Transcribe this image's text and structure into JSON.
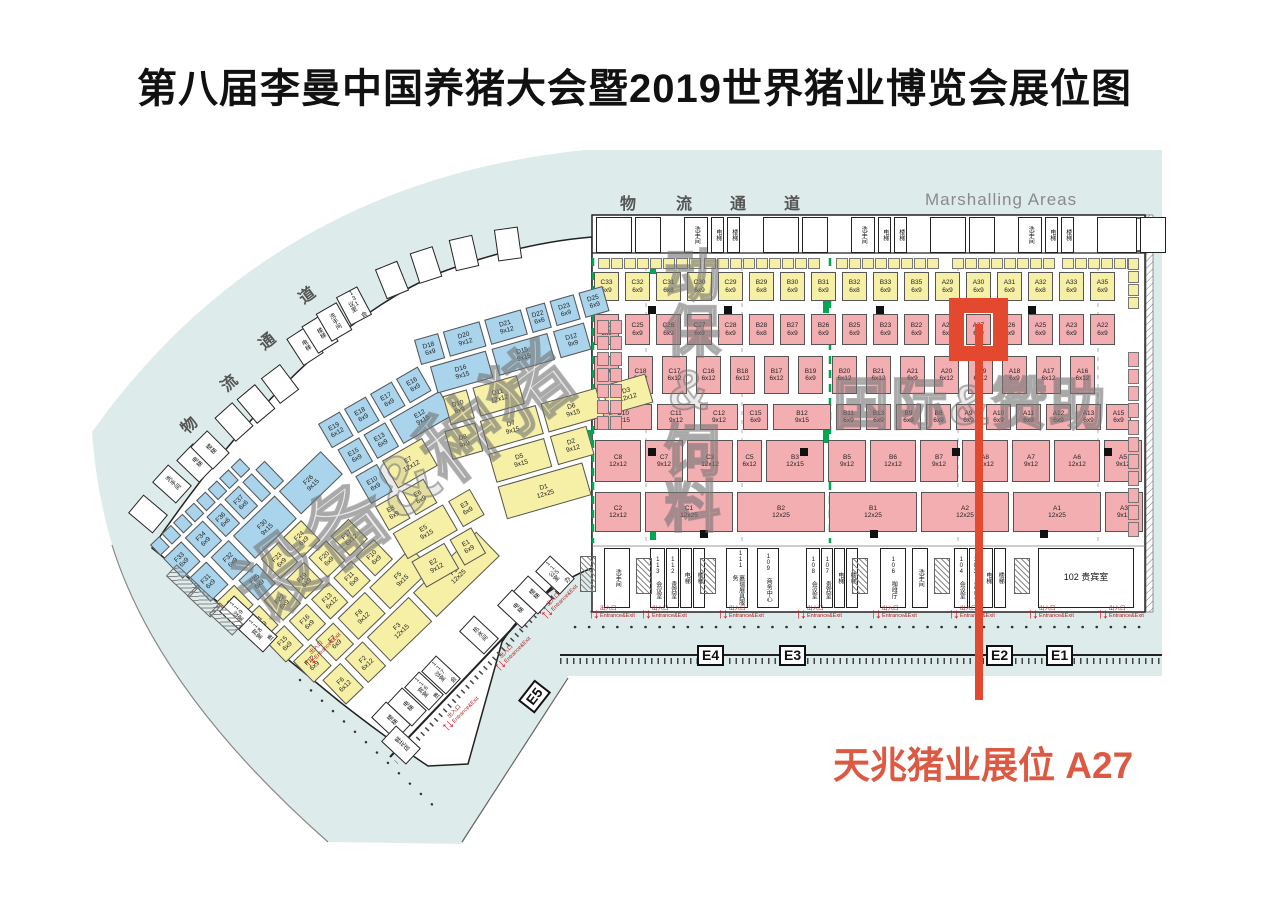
{
  "title": "第八届李曼中国养猪大会暨2019世界猪业博览会展位图",
  "labels": {
    "marshalling": "Marshalling Areas",
    "logistics_top": [
      "物",
      "流",
      "通",
      "道"
    ],
    "logistics_left": [
      "物",
      "流",
      "通",
      "道"
    ],
    "annotation": "天兆猪业展位 A27",
    "entrance_cn": "出入口",
    "entrance_en": "Entrance&Exit",
    "gates": [
      "E4",
      "E3",
      "E2",
      "E1",
      "E5"
    ]
  },
  "watermarks": {
    "equipment": "设备&种猪",
    "feed": "动保&饲料",
    "international": "国际&赞助"
  },
  "rooms": {
    "service": [
      "洗手间",
      "电梯",
      "楼梯"
    ],
    "bottom": [
      "洗手间",
      "113 会议室",
      "112 贵宾室",
      "电梯",
      "楼梯",
      "111 嘉瑞展具服务",
      "109 商务中心",
      "108 会议室",
      "107 贵宾室",
      "电梯",
      "楼梯",
      "106 咖啡厅",
      "洗手间",
      "104 会议室",
      "103 贵宾室",
      "电梯",
      "楼梯",
      "102 贵宾室"
    ],
    "curve": [
      "洗手间",
      "电梯",
      "楼梯",
      "电梯",
      "楼梯",
      "洗手间",
      "131 会议室"
    ],
    "fan_bottom": [
      "115 办公室",
      "楼梯",
      "电梯",
      "热水间",
      "117 会议室",
      "116 贵宾室",
      "电梯",
      "楼梯",
      "119 会议室",
      "118 贵宾室",
      "鲜花店"
    ]
  },
  "colors": {
    "concourse_teal": "#DDECEA",
    "booth_pink": "#F3AEB2",
    "booth_yellow": "#F6EFA6",
    "booth_blue": "#A9D4EB",
    "zone_green": "#00A651",
    "highlight_red": "#E2492E",
    "annotation_red": "#DC5A43"
  },
  "highlight": {
    "booth": "A27",
    "label": "天兆猪业展位 A27"
  },
  "halls": {
    "right": {
      "rows": [
        [
          [
            "C33",
            "6x9",
            "y"
          ],
          [
            "C32",
            "6x9",
            "y"
          ],
          [
            "C31",
            "6x8",
            "y"
          ],
          [
            "C30",
            "6x9",
            "y"
          ],
          [
            "C29",
            "6x9",
            "y"
          ],
          [
            "B29",
            "6x8",
            "y"
          ],
          [
            "B30",
            "6x9",
            "y"
          ],
          [
            "B31",
            "6x9",
            "y"
          ],
          [
            "B32",
            "6x8",
            "y"
          ],
          [
            "B33",
            "6x9",
            "y"
          ],
          [
            "B35",
            "6x9",
            "y"
          ],
          [
            "A29",
            "6x9",
            "y"
          ],
          [
            "A30",
            "6x9",
            "y"
          ],
          [
            "A31",
            "6x9",
            "y"
          ],
          [
            "A32",
            "6x8",
            "y"
          ],
          [
            "A33",
            "6x9",
            "y"
          ],
          [
            "A35",
            "6x9",
            "y"
          ]
        ],
        [
          [
            "C23",
            "6x9",
            "p"
          ],
          [
            "C25",
            "6x9",
            "p"
          ],
          [
            "C26",
            "6x9",
            "p"
          ],
          [
            "C27",
            "6x9",
            "p"
          ],
          [
            "C28",
            "6x9",
            "p"
          ],
          [
            "B28",
            "6x8",
            "p"
          ],
          [
            "B27",
            "6x9",
            "p"
          ],
          [
            "B26",
            "6x9",
            "p"
          ],
          [
            "B25",
            "6x9",
            "p"
          ],
          [
            "B23",
            "6x9",
            "p"
          ],
          [
            "B22",
            "6x9",
            "p"
          ],
          [
            "A28",
            "6x9",
            "p"
          ],
          [
            "A27",
            "6x9",
            "p",
            "hl"
          ],
          [
            "A26",
            "6x9",
            "p"
          ],
          [
            "A25",
            "6x9",
            "p"
          ],
          [
            "A23",
            "6x9",
            "p"
          ],
          [
            "A22",
            "6x9",
            "p"
          ]
        ],
        [
          [
            "C20",
            "6x12",
            "p"
          ],
          [
            "C18",
            "6x12",
            "p"
          ],
          [
            "C17",
            "6x12",
            "p"
          ],
          [
            "C16",
            "6x12",
            "p"
          ],
          [
            "B18",
            "6x12",
            "p"
          ],
          [
            "B17",
            "6x12",
            "p"
          ],
          [
            "B19",
            "6x9",
            "p"
          ],
          [
            "B20",
            "6x12",
            "p"
          ],
          [
            "B21",
            "6x12",
            "p"
          ],
          [
            "A21",
            "6x9",
            "p"
          ],
          [
            "A20",
            "6x12",
            "p"
          ],
          [
            "A19",
            "6x12",
            "p"
          ],
          [
            "A18",
            "6x9",
            "p"
          ],
          [
            "A17",
            "6x12",
            "p"
          ],
          [
            "A16",
            "6x12",
            "p"
          ]
        ],
        [
          [
            "C10",
            "9x15",
            "p"
          ],
          [
            "C11",
            "9x12",
            "p"
          ],
          [
            "C12",
            "9x12",
            "p"
          ],
          [
            "C15",
            "6x9",
            "p"
          ],
          [
            "B12",
            "9x15",
            "p"
          ],
          [
            "B11",
            "6x9",
            "p"
          ],
          [
            "B13",
            "6x9",
            "p"
          ],
          [
            "B9",
            "6x9",
            "p"
          ],
          [
            "B8",
            "6x9",
            "p"
          ],
          [
            "A9",
            "6x9",
            "p"
          ],
          [
            "A10",
            "6x9",
            "p"
          ],
          [
            "A11",
            "6x9",
            "p"
          ],
          [
            "A12",
            "6x9",
            "p"
          ],
          [
            "A13",
            "6x9",
            "p"
          ],
          [
            "A15",
            "6x9",
            "p"
          ]
        ],
        [
          [
            "C8",
            "12x12",
            "p"
          ],
          [
            "C7",
            "9x12",
            "p"
          ],
          [
            "C3",
            "12x12",
            "p"
          ],
          [
            "C5",
            "6x12",
            "p"
          ],
          [
            "B3",
            "12x15",
            "p"
          ],
          [
            "B5",
            "9x12",
            "p"
          ],
          [
            "B6",
            "12x12",
            "p"
          ],
          [
            "B7",
            "9x12",
            "p"
          ],
          [
            "A8",
            "12x12",
            "p"
          ],
          [
            "A7",
            "9x12",
            "p"
          ],
          [
            "A6",
            "12x12",
            "p"
          ],
          [
            "A5",
            "9x12",
            "p"
          ]
        ],
        [
          [
            "C2",
            "12x12",
            "p"
          ],
          [
            "C1",
            "12x25",
            "p"
          ],
          [
            "B2",
            "12x25",
            "p"
          ],
          [
            "B1",
            "12x25",
            "p"
          ],
          [
            "A2",
            "12x25",
            "p"
          ],
          [
            "A1",
            "12x25",
            "p"
          ],
          [
            "A3",
            "9x12",
            "p"
          ]
        ]
      ]
    },
    "fan": {
      "groups": [
        {
          "name": "F",
          "rows": [
            [
              [
                "",
                "3x3",
                "b"
              ],
              [
                "",
                "3x3",
                "b"
              ],
              [
                "",
                "3x3",
                "b"
              ],
              [
                "",
                "3x3",
                "b"
              ],
              [
                "",
                "3x3",
                "b"
              ],
              [
                "",
                "3x3",
                "b"
              ],
              [
                "",
                "3x3",
                "b"
              ],
              [
                "",
                "3x3",
                "b"
              ]
            ],
            [
              [
                "F33",
                "6x9",
                "b"
              ],
              [
                "F34",
                "6x9",
                "b"
              ],
              [
                "F36",
                "6x6",
                "b"
              ],
              [
                "F37",
                "6x6",
                "b"
              ],
              [
                "",
                "3x3",
                "b"
              ],
              [
                "",
                "3x3",
                "b"
              ]
            ],
            [
              [
                "F31",
                "6x9",
                "b"
              ],
              [
                "F32",
                "6x9",
                "b"
              ],
              [
                "F30",
                "9x15",
                "b"
              ],
              [
                "F26",
                "9x15",
                "b"
              ]
            ],
            [
              [
                "F28",
                "6x9",
                "y"
              ],
              [
                "F25",
                "6x9",
                "b"
              ],
              [
                "F23",
                "6x9",
                "y"
              ],
              [
                "F24",
                "6x9",
                "y"
              ]
            ],
            [
              [
                "F21",
                "6x9",
                "y"
              ],
              [
                "F22",
                "6x9",
                "y"
              ],
              [
                "F19",
                "6x9",
                "y"
              ],
              [
                "F20",
                "6x9",
                "y"
              ],
              [
                "F17",
                "6x12",
                "y"
              ]
            ],
            [
              [
                "F15",
                "6x9",
                "y"
              ],
              [
                "F16",
                "6x9",
                "y"
              ],
              [
                "F13",
                "6x12",
                "y"
              ],
              [
                "F11",
                "6x9",
                "y"
              ],
              [
                "F10",
                "6x9",
                "y"
              ]
            ],
            [
              [
                "F12",
                "6x9",
                "y"
              ],
              [
                "F7",
                "6x9",
                "y"
              ],
              [
                "F8",
                "9x12",
                "y"
              ],
              [
                "F5",
                "9x15",
                "y"
              ]
            ],
            [
              [
                "F6",
                "6x12",
                "y"
              ],
              [
                "F2",
                "6x12",
                "y"
              ],
              [
                "F3",
                "12x15",
                "y"
              ],
              [
                "F1",
                "12x25",
                "y"
              ]
            ]
          ]
        },
        {
          "name": "E",
          "rows": [
            [
              [
                "E19",
                "6x12",
                "b"
              ],
              [
                "E18",
                "6x9",
                "b"
              ],
              [
                "E17",
                "6x9",
                "b"
              ],
              [
                "E16",
                "6x9",
                "b"
              ]
            ],
            [
              [
                "E15",
                "6x9",
                "b"
              ],
              [
                "E13",
                "6x9",
                "b"
              ],
              [
                "E12",
                "9x15",
                "b"
              ]
            ],
            [
              [
                "E10",
                "6x9",
                "b"
              ],
              [
                "E7",
                "12x12",
                "y"
              ]
            ],
            [
              [
                "E8",
                "6x9",
                "y"
              ],
              [
                "E6",
                "6x9",
                "y"
              ]
            ],
            [
              [
                "E5",
                "9x15",
                "y"
              ],
              [
                "E3",
                "6x9",
                "y"
              ]
            ],
            [
              [
                "E2",
                "9x12",
                "y"
              ],
              [
                "E1",
                "6x9",
                "y"
              ]
            ]
          ]
        },
        {
          "name": "D",
          "rows": [
            [
              [
                "D18",
                "6x9",
                "b"
              ],
              [
                "D20",
                "9x12",
                "b"
              ],
              [
                "D21",
                "9x12",
                "b"
              ],
              [
                "D22",
                "6x6",
                "b"
              ],
              [
                "D23",
                "6x9",
                "b"
              ],
              [
                "D25",
                "6x9",
                "b"
              ]
            ],
            [
              [
                "D16",
                "9x15",
                "b"
              ],
              [
                "D15",
                "9x15",
                "b"
              ],
              [
                "D12",
                "9x9",
                "b"
              ]
            ],
            [
              [
                "D10",
                "6x9",
                "y"
              ],
              [
                "D11",
                "12x12",
                "y"
              ]
            ],
            [
              [
                "D8",
                "9x9",
                "y"
              ],
              [
                "D7",
                "9x15",
                "y"
              ],
              [
                "D6",
                "9x15",
                "y"
              ],
              [
                "D3",
                "12x12",
                "y"
              ]
            ],
            [
              [
                "D5",
                "9x15",
                "y"
              ],
              [
                "D2",
                "9x12",
                "y"
              ]
            ],
            [
              [
                "D1",
                "12x25",
                "y"
              ]
            ]
          ]
        }
      ]
    }
  }
}
